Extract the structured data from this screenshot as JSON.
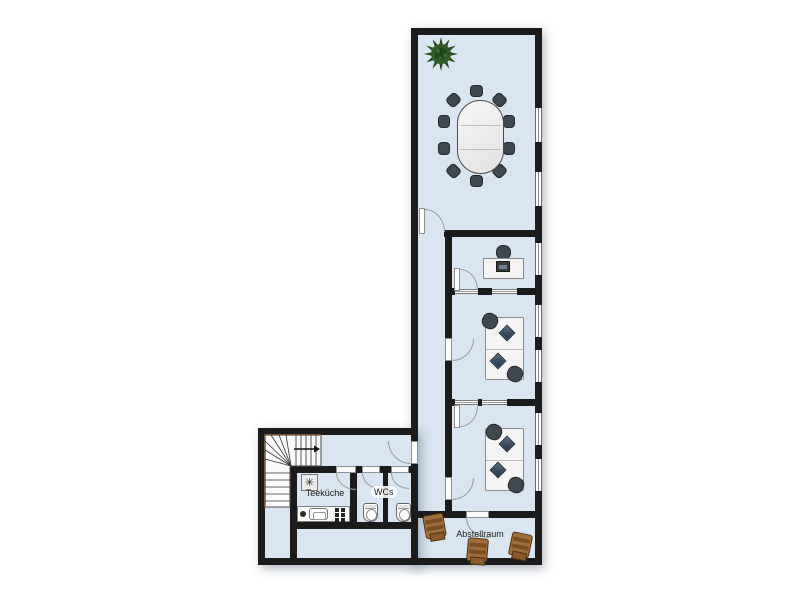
{
  "plan": {
    "labels": {
      "kitchen": "Teeküche",
      "wc": "WCs",
      "storage": "Abstellraum"
    },
    "icons": {
      "freezer_star": "✳"
    },
    "colors": {
      "background": "#ffffff",
      "floor": "#d9e5f1",
      "wall": "#1b1b1b",
      "desk": "#f4f4f4",
      "chair_dark": "#40474f",
      "monitor": "#374a5e",
      "plant_green": "#2a4d20",
      "wood_brown": "#a06f3c",
      "window_frame": "#6b6b6b"
    }
  }
}
